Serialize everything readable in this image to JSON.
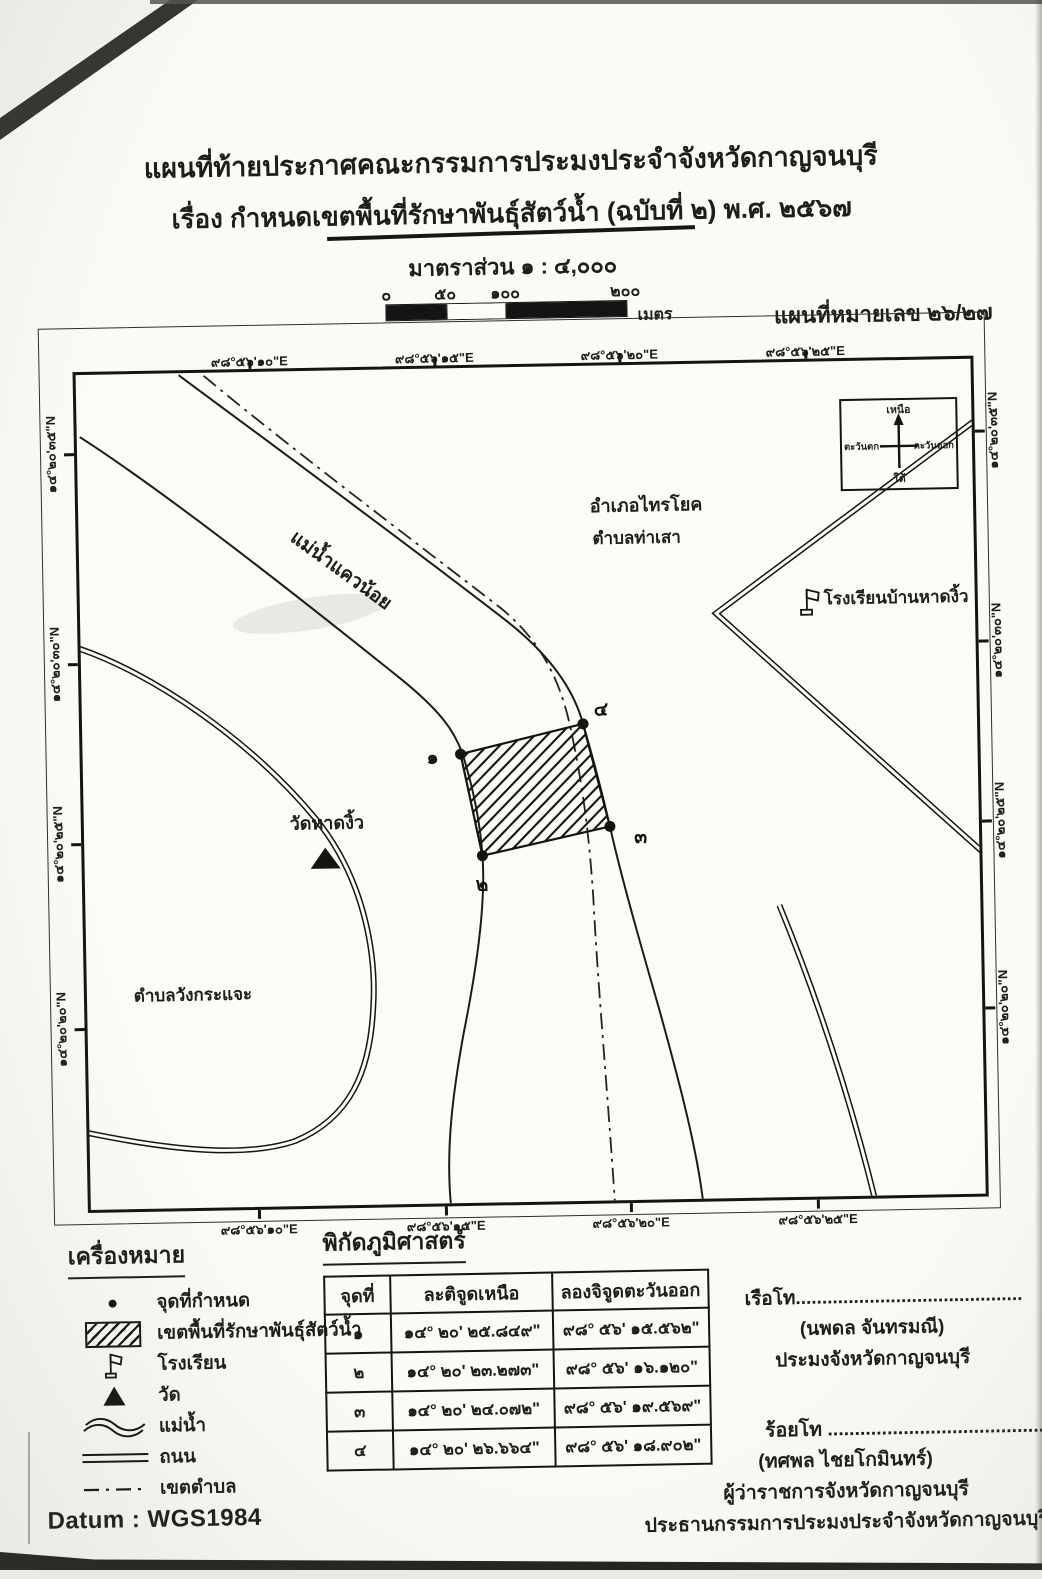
{
  "doc": {
    "title_line1": "แผนที่ท้ายประกาศคณะกรรมการประมงประจำจังหวัดกาญจนบุรี",
    "title_line2": "เรื่อง กำหนดเขตพื้นที่รักษาพันธุ์สัตว์น้ำ (ฉบับที่ ๒) พ.ศ. ๒๕๖๗",
    "map_number": "แผนที่หมายเลข ๒๖/๒๗",
    "datum": "Datum : WGS1984"
  },
  "scale": {
    "label": "มาตราส่วน ๑ : ๔,๐๐๐",
    "tick0": "๐",
    "tick50": "๕๐",
    "tick100": "๑๐๐",
    "tick200": "๒๐๐",
    "unit": "เมตร"
  },
  "map": {
    "coord_labels": {
      "top": [
        "๙๘°๕๖'๑๐\"E",
        "๙๘°๕๖'๑๕\"E",
        "๙๘°๕๖'๒๐\"E",
        "๙๘°๕๖'๒๕\"E"
      ],
      "bottom": [
        "๙๘°๕๖'๑๐\"E",
        "๙๘°๕๖'๑๕\"E",
        "๙๘°๕๖'๒๐\"E",
        "๙๘°๕๖'๒๕\"E"
      ],
      "left": [
        "๑๔°๒๐'๓๕\"N",
        "๑๔°๒๐'๓๐\"N",
        "๑๔°๒๐'๒๕\"N",
        "๑๔°๒๐'๒๐\"N"
      ],
      "right": [
        "๑๔°๒๐'๓๕\"N",
        "๑๔°๒๐'๓๐\"N",
        "๑๔°๒๐'๒๕\"N",
        "๑๔°๒๐'๒๐\"N"
      ]
    },
    "labels": {
      "district": "อำเภอไทรโยค",
      "subdistrict_thasao": "ตำบลท่าเสา",
      "school": "โรงเรียนบ้านหาดงิ้ว",
      "river": "แม่น้ำแควน้อย",
      "temple": "วัดหาดงิ้ว",
      "subdistrict_wang": "ตำบลวังกระแจะ"
    },
    "points": {
      "p1": "๑",
      "p2": "๒",
      "p3": "๓",
      "p4": "๔"
    },
    "compass": {
      "north": "เหนือ",
      "south": "ใต้",
      "west": "ตะวันตก",
      "east": "ตะวันออก"
    }
  },
  "legend": {
    "heading": "เครื่องหมาย",
    "items": [
      {
        "symbol": "point-dot",
        "label": "จุดที่กำหนด"
      },
      {
        "symbol": "hatched-area",
        "label": "เขตพื้นที่รักษาพันธุ์สัตว์น้ำ"
      },
      {
        "symbol": "school-flag",
        "label": "โรงเรียน"
      },
      {
        "symbol": "temple-triangle",
        "label": "วัด"
      },
      {
        "symbol": "river-waves",
        "label": "แม่น้ำ"
      },
      {
        "symbol": "road-double-line",
        "label": "ถนน"
      },
      {
        "symbol": "boundary-dash-dot",
        "label": "เขตตำบล"
      }
    ]
  },
  "coords_table": {
    "heading": "พิกัดภูมิศาสตร์",
    "col_point": "จุดที่",
    "col_lat": "ละติจูดเหนือ",
    "col_lon": "ลองจิจูดตะวันออก",
    "rows": [
      {
        "point": "๑",
        "lat": "๑๔° ๒๐' ๒๕.๘๔๙\"",
        "lon": "๙๘° ๕๖' ๑๕.๕๖๒\""
      },
      {
        "point": "๒",
        "lat": "๑๔° ๒๐' ๒๓.๒๗๓\"",
        "lon": "๙๘° ๕๖' ๑๖.๑๒๐\""
      },
      {
        "point": "๓",
        "lat": "๑๔° ๒๐' ๒๔.๐๗๒\"",
        "lon": "๙๘° ๕๖' ๑๙.๕๖๙\""
      },
      {
        "point": "๔",
        "lat": "๑๔° ๒๐' ๒๖.๖๖๔\"",
        "lon": "๙๘° ๕๖' ๑๘.๙๐๒\""
      }
    ]
  },
  "signatures": {
    "sig1": {
      "rank": "เรือโท",
      "dots": "...........................................",
      "name": "(นพดล จันทรมณี)",
      "title1": "ประมงจังหวัดกาญจนบุรี"
    },
    "sig2": {
      "rank": "ร้อยโท ",
      "dots": "..........................................",
      "name": "(ทศพล ไชยโกมินทร์)",
      "title1": "ผู้ว่าราชการจังหวัดกาญจนบุรี",
      "title2": "ประธานกรรมการประมงประจำจังหวัดกาญจนบุรี"
    }
  },
  "colors": {
    "ink": "#1d1d1b",
    "paper": "#fafaf7"
  }
}
